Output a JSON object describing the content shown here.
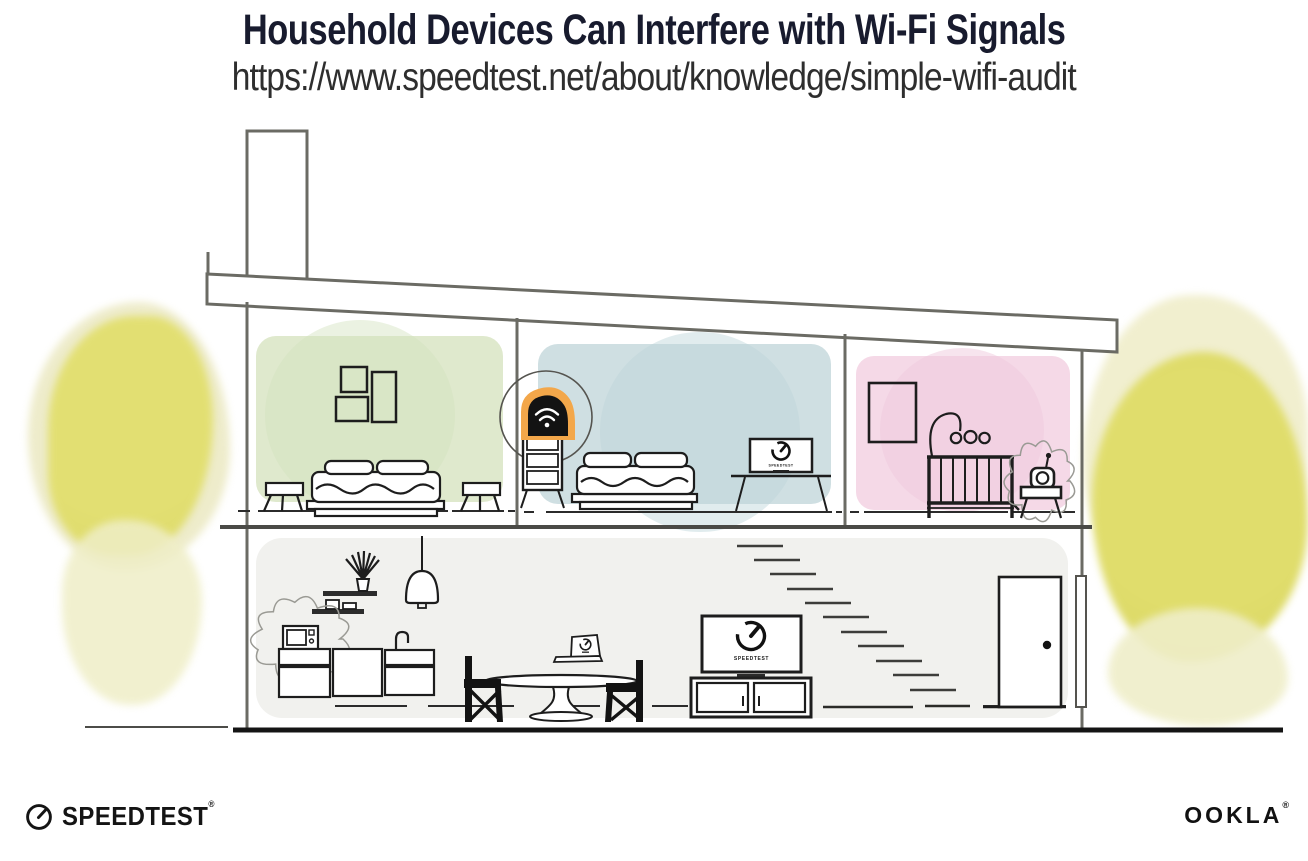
{
  "header": {
    "title": "Household Devices Can Interfere with Wi-Fi Signals",
    "url": "https://www.speedtest.net/about/knowledge/simple-wifi-audit"
  },
  "screens": {
    "living_tv_label": "SPEEDTEST",
    "bedroom_tv_label": "SPEEDTEST",
    "laptop_label": "SPEEDTEST"
  },
  "branding": {
    "speedtest_wordmark": "SPEEDTEST",
    "speedtest_trademark": "®",
    "ookla_wordmark": "OOKLA",
    "ookla_trademark": "®"
  },
  "icons": {
    "router": "wifi-icon",
    "speedtest": "speedometer-gauge-icon",
    "interference": "interference-burst-outline"
  },
  "colors": {
    "title_text": "#181b2e",
    "url_text": "#2e2e2e",
    "room_green": "#dfe9cd",
    "room_blue": "#cfdfe2",
    "room_pink": "#f5d9e7",
    "lower_floor_gray": "#f1f1ee",
    "tree_yellow": "#e0dd6c",
    "router_glow_orange": "#f3a74a",
    "structure_line_gray": "#6b6b64",
    "ink_black": "#1d1d1d"
  }
}
